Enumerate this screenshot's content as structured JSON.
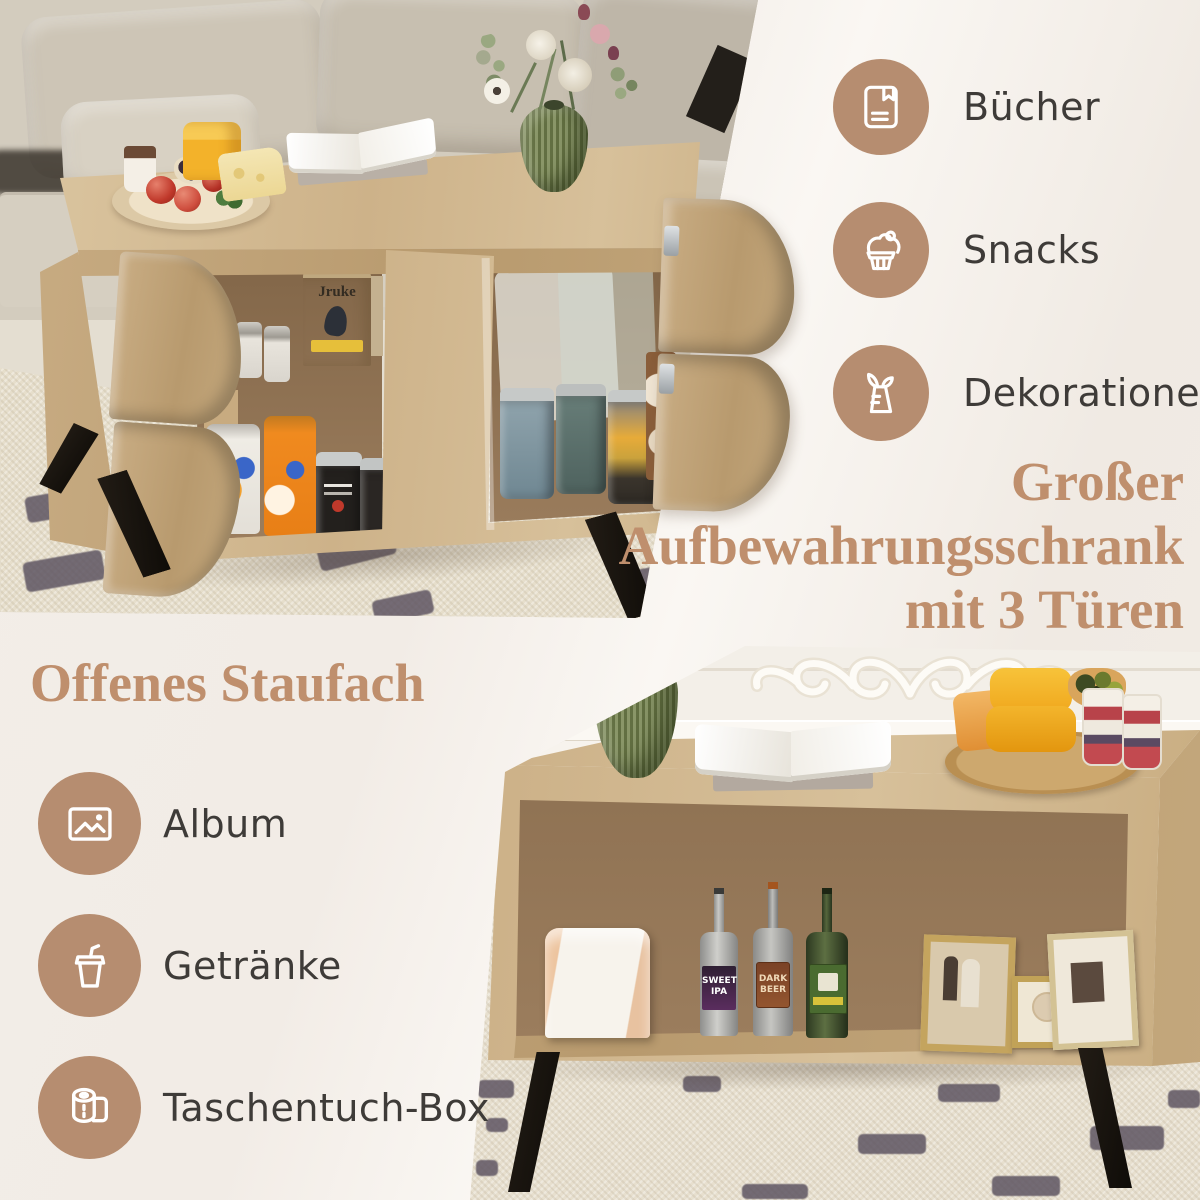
{
  "page": {
    "background": "#f2ece6",
    "accent": "#bf8f6d",
    "badge_circle": "#b68d70",
    "badge_icon_color": "#ffffff",
    "label_color": "#3e3b38"
  },
  "top_right_panel": {
    "features": [
      {
        "icon": "book-icon",
        "label": "Bücher"
      },
      {
        "icon": "cupcake-icon",
        "label": "Snacks"
      },
      {
        "icon": "vase-icon",
        "label": "Dekorationen"
      }
    ],
    "heading": {
      "line1": "Großer",
      "line2": "Aufbewahrungsschrank",
      "line3": "mit 3 Türen"
    }
  },
  "bottom_left_panel": {
    "heading": "Offenes Staufach",
    "features": [
      {
        "icon": "album-icon",
        "label": "Album"
      },
      {
        "icon": "drink-cup-icon",
        "label": "Getränke"
      },
      {
        "icon": "toilet-paper-icon",
        "label": "Taschentuch-Box"
      }
    ]
  },
  "photo_top": {
    "scene": "Couchtisch mit 3 geöffneten Türen – Dosen, Snacks und Vorräte im Stauraum, davor beiges Sofa",
    "coffee_bag_brand": "Jruke"
  },
  "photo_bottom": {
    "scene": "Couchtisch-Rückseite mit offenem Staufach – Tissue-Box, Flaschen und Bilderrahmen",
    "bottle_label_1": "SWEET IPA",
    "bottle_label_2": "DARK BEER"
  }
}
